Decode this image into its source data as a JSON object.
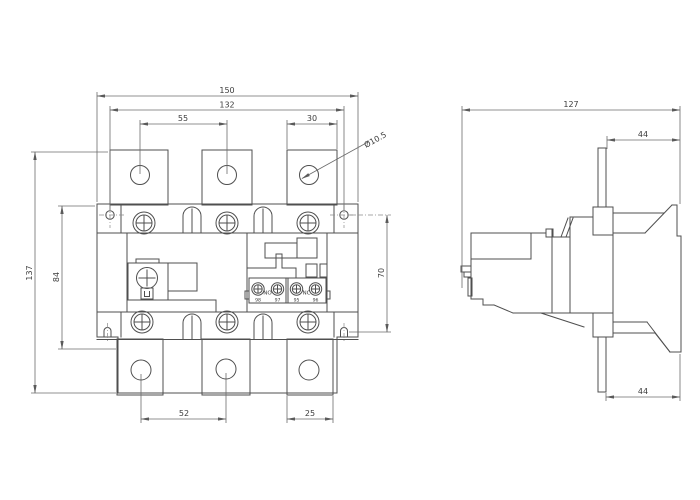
{
  "colors": {
    "background": "#ffffff",
    "line": "#4f4f4f",
    "dimension_line": "#6b6b6b",
    "text": "#3c3c3c"
  },
  "front_view": {
    "dimensions": {
      "overall_width": "150",
      "mounting_hole_span": "132",
      "top_terminal_pitch": "55",
      "top_terminal_width": "30",
      "terminal_hole_diameter": "Ø10.5",
      "overall_height": "137",
      "left_inner_height": "84",
      "right_mounting_height": "70",
      "bottom_terminal_pitch": "52",
      "bottom_terminal_width": "25"
    },
    "aux_contacts": {
      "no_label": "NO",
      "nc_label": "NC",
      "terminal_1": "98",
      "terminal_2": "97",
      "terminal_3": "95",
      "terminal_4": "96"
    }
  },
  "side_view": {
    "dimensions": {
      "overall_depth": "127",
      "top_blade_to_back": "44",
      "bottom_blade_to_back": "44"
    }
  }
}
